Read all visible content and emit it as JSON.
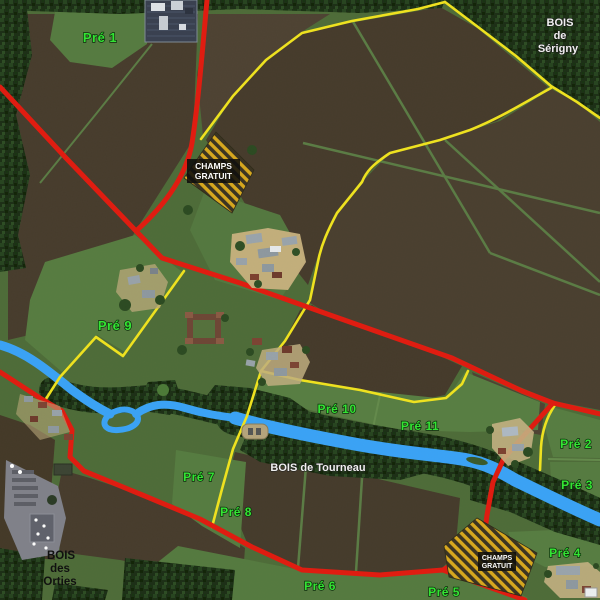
{
  "fields": {
    "pre1": "Pré 1",
    "pre2": "Pré 2",
    "pre3": "Pré 3",
    "pre4": "Pré 4",
    "pre5": "Pré 5",
    "pre6": "Pré 6",
    "pre7": "Pré 7",
    "pre8": "Pré 8",
    "pre9": "Pré 9",
    "pre10": "Pré 10",
    "pre11": "Pré 11"
  },
  "forests": {
    "serigny": {
      "line1": "BOIS",
      "line2": "de",
      "line3": "Sérigny"
    },
    "tourneau": {
      "label": "BOIS de Tourneau"
    },
    "orties": {
      "line1": "BOIS",
      "line2": "des",
      "line3": "Orties"
    }
  },
  "signs": {
    "free_fields": {
      "line1": "CHAMPS",
      "line2": "GRATUIT"
    }
  },
  "colors": {
    "road_main": "#e11b10",
    "road_secondary": "#f0e31f",
    "river": "#3aa3f7",
    "field_label": "#33e633",
    "forest_label": "#f2f2f2",
    "forest_label_dark": "#0f0f0f",
    "sign_background": "#0d0d0d",
    "sign_text": "#ffffff",
    "hatch_yellow": "#d8a81e",
    "meadow_green": "#557a40",
    "ploughed_brown": "#473c2d"
  }
}
